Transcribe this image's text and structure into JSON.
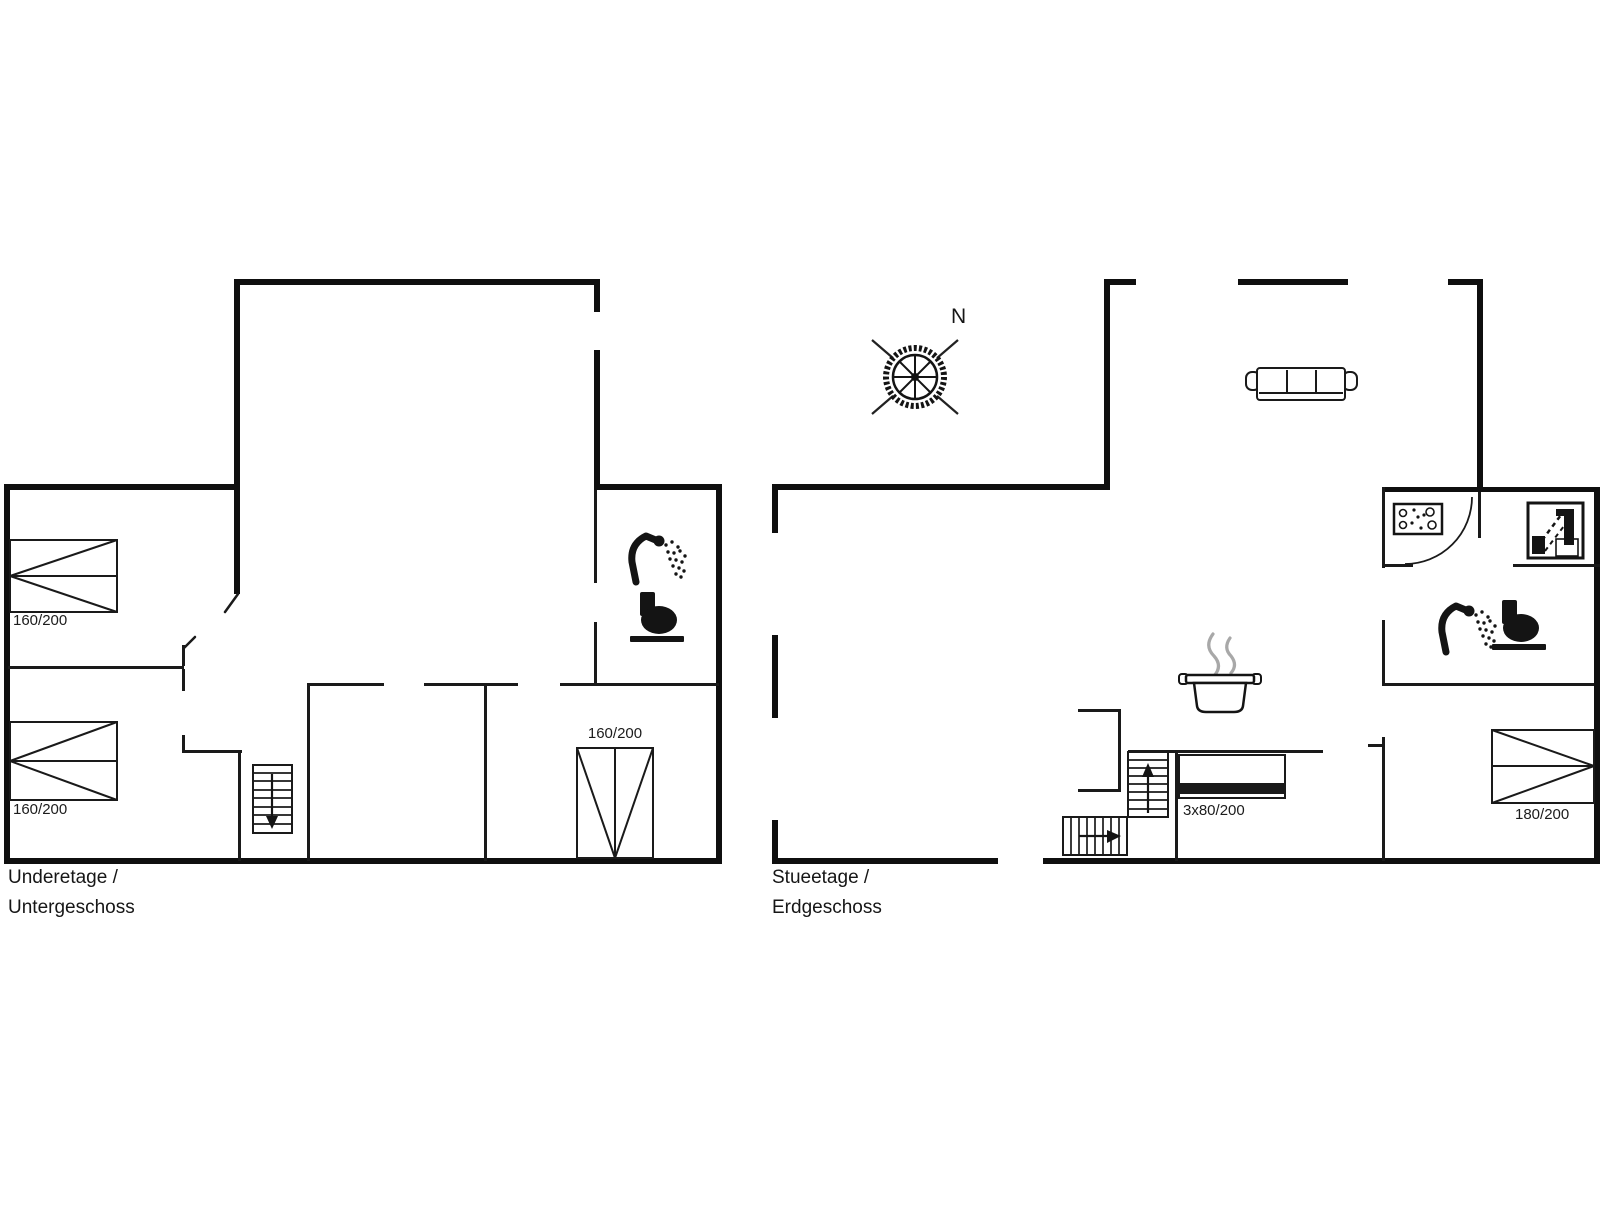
{
  "canvas": {
    "width": 1606,
    "height": 1205,
    "background": "#ffffff"
  },
  "colors": {
    "outer_wall": "#0f0f0f",
    "interior_wall": "#1a1a1a",
    "steam": "#a8a8a8",
    "text": "#1c1c1c"
  },
  "floors": {
    "lower": {
      "label_line1": "Underetage /",
      "label_line2": "Untergeschoss",
      "beds": [
        {
          "label": "160/200"
        },
        {
          "label": "160/200"
        },
        {
          "label": "160/200"
        }
      ],
      "icons": [
        "shower-icon",
        "toilet-icon",
        "stairs-down-icon",
        "door-leaf-icon"
      ]
    },
    "ground": {
      "label_line1": "Stueetage /",
      "label_line2": "Erdgeschoss",
      "compass_label": "N",
      "beds": [
        {
          "label": "3x80/200"
        },
        {
          "label": "180/200"
        }
      ],
      "icons": [
        "compass-rose-icon",
        "sofa-icon",
        "stove-pot-icon",
        "washing-machine-icon",
        "sink-icon",
        "shower-icon",
        "toilet-icon",
        "stairs-up-icon",
        "stairs-entry-icon",
        "door-swing-arc-icon",
        "bunk-bed-icon"
      ]
    }
  }
}
